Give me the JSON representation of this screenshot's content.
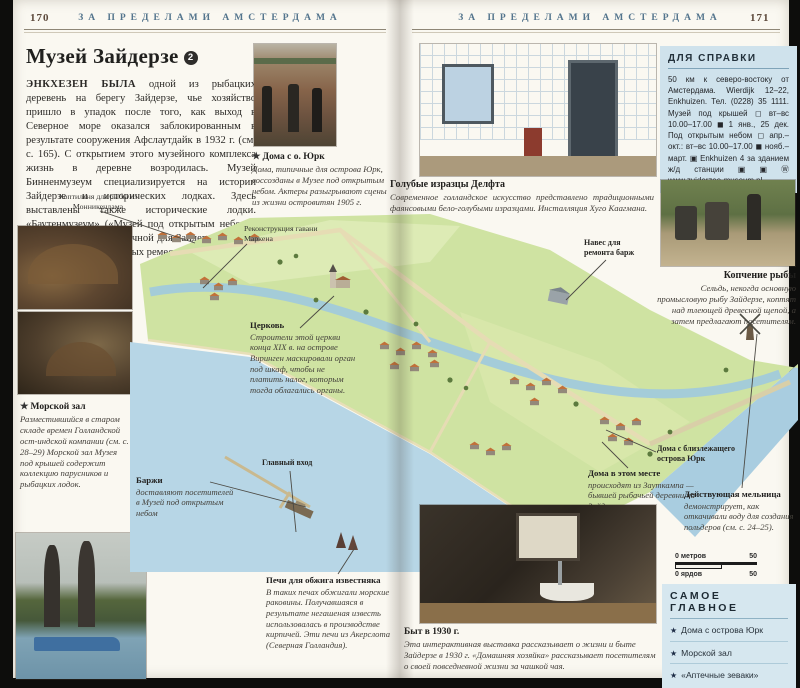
{
  "page": {
    "left_number": "170",
    "right_number": "171",
    "running_head": "ЗА ПРЕДЕЛАМИ АМСТЕРДАМА"
  },
  "article": {
    "title": "Музей Зайдерзе",
    "badge": "2",
    "intro_lead": "ЭНКХЕЗЕН БЫЛА",
    "intro": " одной из рыбацких деревень на берегу Зайдерзе, чье хозяйство пришло в упадок после того, как выход в Северное море оказался заблокированным в результате сооружения Афслаутдайк в 1932 г. (см. с. 165). С открытием этого музейного комплекса жизнь в деревне возродилась. Музей Бинненмузеум специализируется на истории Зайдерзе и исторических лодках. Здесь выставлены также исторические лодки. «Баутенмузеум» («Музей под открытым небом») — реконструкция типичной для Зайдерзе деревни с демонстрацией местных ремесел."
  },
  "captions": {
    "yurk": {
      "star": "★",
      "title": "Дома с о. Юрк",
      "text": "Дома, типичные для острова Юрк, воссозданы в Музее под открытым небом. Актеры разыгрывают сцены из жизни островитян 1905 г."
    },
    "sea_hall": {
      "star": "★",
      "title": "Морской зал",
      "text": "Разместившийся в старом складе времен Голландской ост-индской компании (см. с. 28–29) Морской зал Музея под крышей содержит коллекцию парусников и рыбацких лодок."
    },
    "delft": {
      "title": "Голубые изразцы Делфта",
      "text": "Современное голландское искусство представлено традиционными фаянсовыми бело-голубыми изразцами. Инсталляция Хуго Каагмана."
    },
    "smoking": {
      "title": "Копчение рыбы",
      "text": "Сельдь, некогда основную промысловую рыбу Зайдерзе, коптят над тлеющей древесной щепой, а затем предлагают посетителям."
    },
    "life_1930": {
      "title": "Быт в 1930 г.",
      "text": "Эта интерактивная выставка рассказывает о жизни и быте Зайдерзе в 1930 г. «Домашняя хозяйка» рассказывает посетителям о своей повседневной жизни за чашкой чая."
    }
  },
  "map": {
    "labels": {
      "smokehouse": "Коптильня для рыбы из Монникендама",
      "marken": "Реконструкция гавани Маркена",
      "main_entrance": "Главный вход",
      "shed": "Навес для ремонта барж",
      "yurk_nearby": "Дома с близлежащего острова Юрк"
    },
    "callouts": {
      "church": {
        "title": "Церковь",
        "text": "Строители этой церкви конца XIX в. на острове Виринген маскировали орган под шкаф, чтобы не платить налог, которым тогда облагались органы."
      },
      "barges": {
        "title": "Баржи",
        "text": "доставляют посетителей в Музей под открытым небом"
      },
      "houses_here": {
        "title": "Дома в этом месте",
        "text": "происходят из Зауткампа — бывшей рыбачьей деревни на Зайдерзе."
      },
      "mill": {
        "title": "Действующая мельница",
        "text": "демонстрирует, как откачивали воду для создания польдеров (см. с. 24–25)."
      },
      "kilns": {
        "title": "Печи для обжига известняка",
        "text": "В таких печах обжигали морские раковины. Получавшаяся в результате негашеная известь использовалась в производстве кирпичей. Эти печи из Акерслота (Северная Голландия)."
      }
    },
    "scalebar": {
      "meters": "0 метров",
      "yards": "0 ярдов",
      "max": "50"
    }
  },
  "infobox": {
    "title": "ДЛЯ СПРАВКИ",
    "text": "50 км к северо-востоку от Амстердама. Wierdijk 12–22, Enkhuizen. Тел. (0228) 35 1111. Музей под крышей ◻ вт–вс 10.00–17.00 ◼ 1 янв., 25 дек. Под открытым небом ◻ апр.–окт.: вт–вс 10.00–17.00 ◼ нояб.–март. ▣ Enkhuizen 4 за зданием ж/д станции ▣ ▣ Ⓦ www.zuiderzee-museum.nl"
  },
  "highlights": {
    "title": "САМОЕ  ГЛАВНОЕ",
    "bullet": "★",
    "items": [
      "Дома с острова Юрк",
      "Морской зал",
      "«Аптечные зеваки»"
    ]
  },
  "colors": {
    "infobox_bg": "#cfe2ec",
    "highlights_bg": "#d6e7ef",
    "running_head": "#54758d",
    "map_water": "#b7d6e6",
    "map_land": "#cfe3a2",
    "roof": "#c1713a"
  }
}
